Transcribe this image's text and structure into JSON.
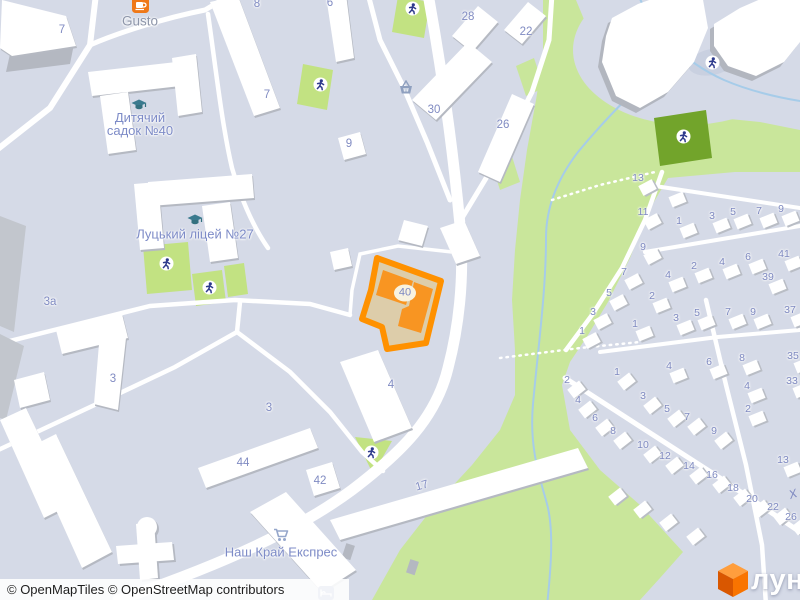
{
  "attribution": {
    "text": "© OpenMapTiles © OpenStreetMap contributors"
  },
  "logo": {
    "text": "лун"
  },
  "subject": {
    "number": "40"
  },
  "street_partial": {
    "text": "Х",
    "x": 794,
    "y": 493
  },
  "colors": {
    "background": "#d5dae7",
    "highlight_border": "#ff9100",
    "highlight_fill": "#f89522",
    "courtyard": "#ddcdaa",
    "green": "#c9e69b",
    "playground_green": "#c2e282",
    "dark_green": "#72a42b",
    "water": "#a6cce9",
    "label_blue": "#7e89c0",
    "road": "#ffffff"
  },
  "pois": [
    {
      "id": "gusto",
      "icon": "cafe",
      "ix": 140,
      "iy": 5,
      "lines": [
        "Gusto"
      ],
      "lx": 140,
      "ly": 21,
      "cls": "poi-gray"
    },
    {
      "id": "kindergarten",
      "icon": "school",
      "ix": 139,
      "iy": 105,
      "lines": [
        "Дитячий",
        "садок №40"
      ],
      "lx": 140,
      "ly": 124,
      "cls": "poi-blue"
    },
    {
      "id": "lyceum",
      "icon": "school",
      "ix": 195,
      "iy": 220,
      "lines": [
        "Луцький ліцей №27"
      ],
      "lx": 195,
      "ly": 234,
      "cls": "poi-blue"
    },
    {
      "id": "nash-krai",
      "icon": "cart",
      "ix": 281,
      "iy": 535,
      "lines": [
        "Наш Край Експрес"
      ],
      "lx": 281,
      "ly": 552,
      "cls": "poi-blue"
    }
  ],
  "misc_icons": [
    {
      "icon": "basket",
      "x": 406,
      "y": 87
    },
    {
      "icon": "bed",
      "x": 326,
      "y": 593
    }
  ],
  "playgrounds": [
    {
      "x": 412,
      "y": 8
    },
    {
      "x": 320,
      "y": 84
    },
    {
      "x": 166,
      "y": 263
    },
    {
      "x": 209,
      "y": 287
    },
    {
      "x": 712,
      "y": 62
    },
    {
      "x": 683,
      "y": 136
    },
    {
      "x": 371,
      "y": 452
    }
  ],
  "building_numbers": [
    {
      "t": "7",
      "x": 62,
      "y": 30
    },
    {
      "t": "8",
      "x": 257,
      "y": 4
    },
    {
      "t": "6",
      "x": 330,
      "y": 3
    },
    {
      "t": "7",
      "x": 267,
      "y": 95
    },
    {
      "t": "9",
      "x": 349,
      "y": 144
    },
    {
      "t": "28",
      "x": 468,
      "y": 17
    },
    {
      "t": "22",
      "x": 526,
      "y": 32
    },
    {
      "t": "30",
      "x": 434,
      "y": 110
    },
    {
      "t": "26",
      "x": 503,
      "y": 125
    },
    {
      "t": "3а",
      "x": 50,
      "y": 302
    },
    {
      "t": "3",
      "x": 113,
      "y": 379
    },
    {
      "t": "3",
      "x": 269,
      "y": 408
    },
    {
      "t": "4",
      "x": 391,
      "y": 385
    },
    {
      "t": "42",
      "x": 320,
      "y": 481
    },
    {
      "t": "44",
      "x": 243,
      "y": 463
    },
    {
      "t": "17",
      "x": 422,
      "y": 486,
      "rot": -16
    }
  ],
  "small_houses": [
    {
      "t": "13",
      "x": 638,
      "y": 178,
      "r": -28
    },
    {
      "t": "11",
      "x": 643,
      "y": 212,
      "r": -28
    },
    {
      "t": "9",
      "x": 643,
      "y": 247,
      "r": -28
    },
    {
      "t": "7",
      "x": 624,
      "y": 272,
      "r": -28
    },
    {
      "t": "5",
      "x": 609,
      "y": 293,
      "r": -28
    },
    {
      "t": "3",
      "x": 593,
      "y": 312,
      "r": -28
    },
    {
      "t": "1",
      "x": 582,
      "y": 331,
      "r": -28
    },
    {
      "t": "1",
      "x": 679,
      "y": 221
    },
    {
      "t": "3",
      "x": 712,
      "y": 216
    },
    {
      "t": "5",
      "x": 733,
      "y": 212
    },
    {
      "t": "7",
      "x": 759,
      "y": 211
    },
    {
      "t": "9",
      "x": 781,
      "y": 209
    },
    {
      "t": "4",
      "x": 668,
      "y": 275
    },
    {
      "t": "2",
      "x": 694,
      "y": 266
    },
    {
      "t": "4",
      "x": 722,
      "y": 262
    },
    {
      "t": "6",
      "x": 748,
      "y": 257
    },
    {
      "t": "41",
      "x": 784,
      "y": 254
    },
    {
      "t": "39",
      "x": 768,
      "y": 277
    },
    {
      "t": "2",
      "x": 652,
      "y": 296
    },
    {
      "t": "1",
      "x": 635,
      "y": 324
    },
    {
      "t": "3",
      "x": 676,
      "y": 318
    },
    {
      "t": "5",
      "x": 697,
      "y": 313
    },
    {
      "t": "7",
      "x": 728,
      "y": 312
    },
    {
      "t": "9",
      "x": 753,
      "y": 312
    },
    {
      "t": "37",
      "x": 790,
      "y": 310
    },
    {
      "t": "4",
      "x": 669,
      "y": 366
    },
    {
      "t": "6",
      "x": 709,
      "y": 362
    },
    {
      "t": "8",
      "x": 742,
      "y": 358
    },
    {
      "t": "4",
      "x": 747,
      "y": 386
    },
    {
      "t": "2",
      "x": 748,
      "y": 409
    },
    {
      "t": "35",
      "x": 793,
      "y": 356
    },
    {
      "t": "33",
      "x": 792,
      "y": 381
    },
    {
      "t": "13",
      "x": 783,
      "y": 460
    },
    {
      "t": "1",
      "x": 617,
      "y": 372,
      "r": -38
    },
    {
      "t": "3",
      "x": 643,
      "y": 396,
      "r": -38
    },
    {
      "t": "5",
      "x": 667,
      "y": 409,
      "r": -38
    },
    {
      "t": "7",
      "x": 687,
      "y": 417,
      "r": -38
    },
    {
      "t": "9",
      "x": 714,
      "y": 431,
      "r": -38
    },
    {
      "t": "2",
      "x": 567,
      "y": 380,
      "r": -38
    },
    {
      "t": "4",
      "x": 578,
      "y": 400,
      "r": -38
    },
    {
      "t": "6",
      "x": 595,
      "y": 418,
      "r": -38
    },
    {
      "t": "8",
      "x": 613,
      "y": 431,
      "r": -38
    },
    {
      "t": "10",
      "x": 643,
      "y": 445,
      "r": -38
    },
    {
      "t": "12",
      "x": 665,
      "y": 456,
      "r": -38
    },
    {
      "t": "14",
      "x": 689,
      "y": 466,
      "r": -38
    },
    {
      "t": "16",
      "x": 712,
      "y": 475,
      "r": -38
    },
    {
      "t": "18",
      "x": 733,
      "y": 488,
      "r": -38
    },
    {
      "t": "20",
      "x": 752,
      "y": 499,
      "r": -38
    },
    {
      "t": "22",
      "x": 773,
      "y": 507,
      "r": -38
    },
    {
      "t": "26",
      "x": 791,
      "y": 517,
      "r": -38
    },
    {
      "t": "",
      "x": 668,
      "y": 190
    },
    {
      "t": "",
      "x": 608,
      "y": 487,
      "r": -38
    },
    {
      "t": "",
      "x": 633,
      "y": 500,
      "r": -38
    },
    {
      "t": "",
      "x": 659,
      "y": 513,
      "r": -38
    },
    {
      "t": "",
      "x": 686,
      "y": 527,
      "r": -38
    }
  ]
}
